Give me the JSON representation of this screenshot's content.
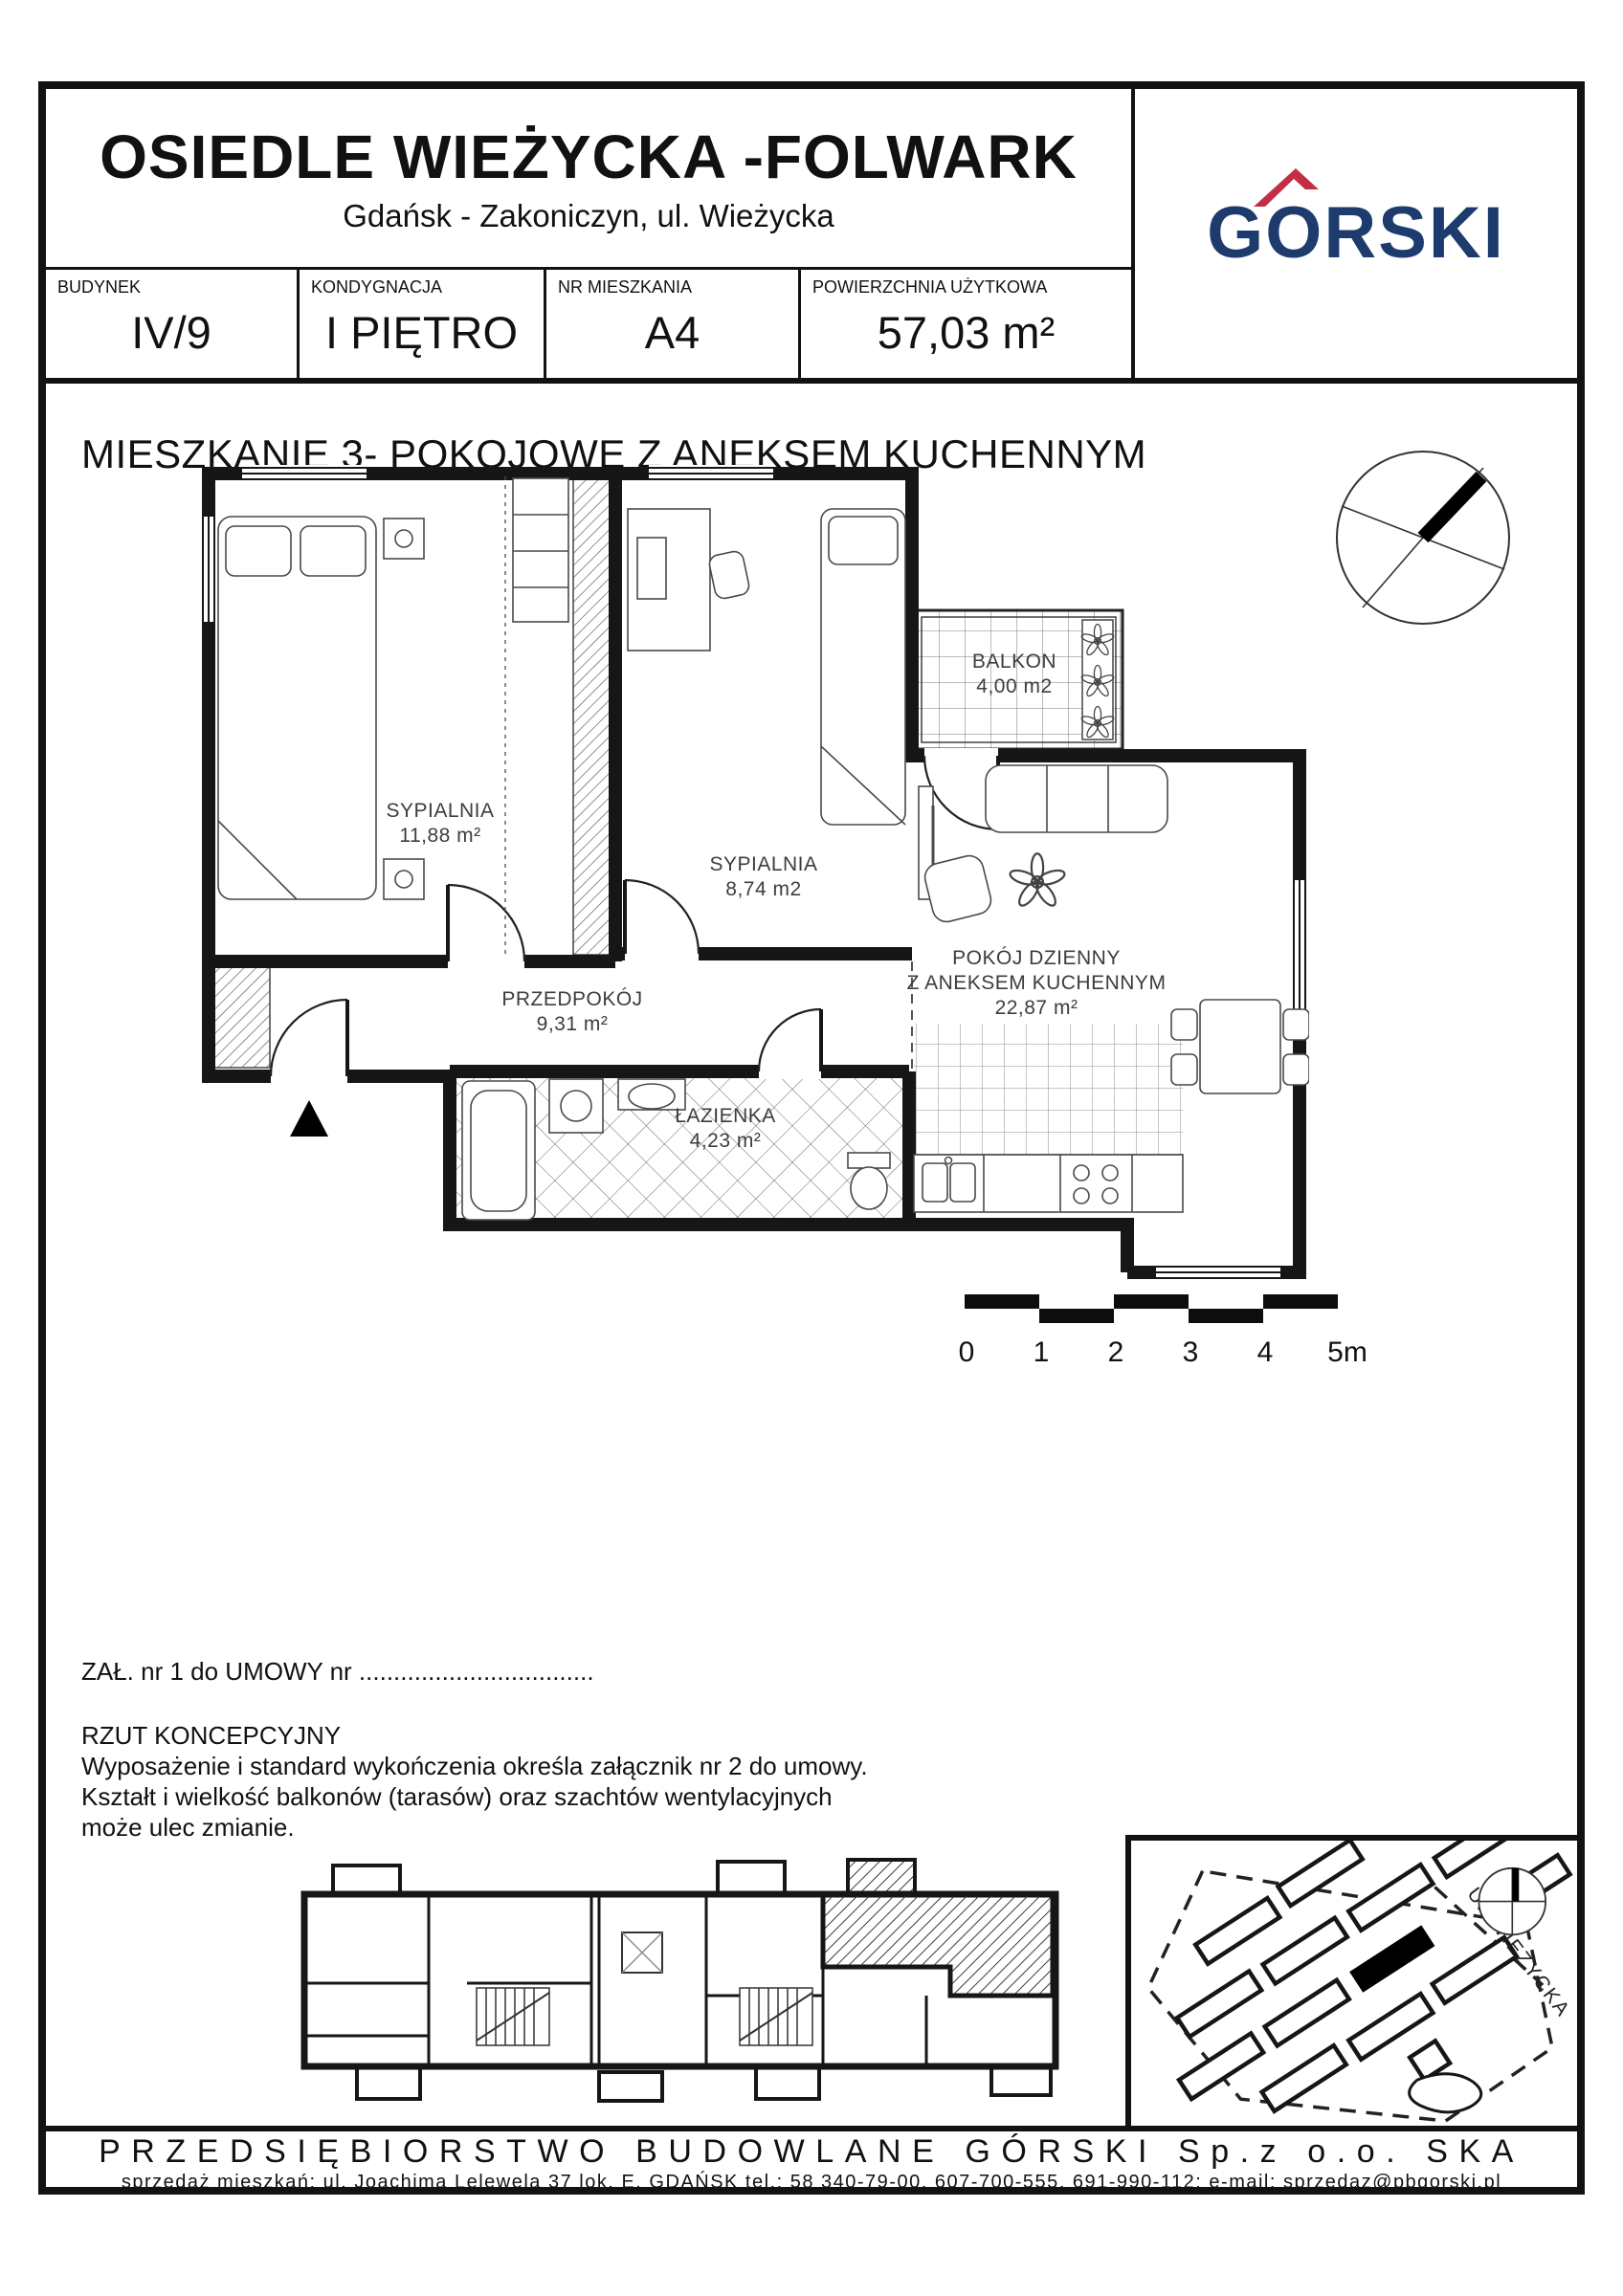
{
  "header": {
    "title": "OSIEDLE WIEŻYCKA -FOLWARK",
    "subtitle": "Gdańsk - Zakoniczyn, ul. Wieżycka",
    "logo": {
      "part_g": "G",
      "part_o": "O",
      "part_rest": "RSKI",
      "text_color": "#1d3c6d",
      "roof_color": "#c22f45"
    }
  },
  "info_table": {
    "cells": [
      {
        "label": "BUDYNEK",
        "value": "IV/9"
      },
      {
        "label": "KONDYGNACJA",
        "value": "I PIĘTRO"
      },
      {
        "label": "NR MIESZKANIA",
        "value": "A4"
      },
      {
        "label": "POWIERZCHNIA UŻYTKOWA",
        "value": "57,03 m²"
      }
    ]
  },
  "plan": {
    "heading": "MIESZKANIE 3- POKOJOWE  Z ANEKSEM KUCHENNYM",
    "rooms": [
      {
        "name": "SYPIALNIA",
        "area": "11,88 m²"
      },
      {
        "name": "SYPIALNIA",
        "area": "8,74 m2"
      },
      {
        "name": "BALKON",
        "area": "4,00 m2"
      },
      {
        "name": "PRZEDPOKÓJ",
        "area": "9,31 m²"
      },
      {
        "name": "ŁAZIENKA",
        "area": "4,23 m²"
      },
      {
        "name": "POKÓJ DZIENNY",
        "name2": "Z ANEKSEM KUCHENNYM",
        "area": "22,87 m²"
      }
    ],
    "scale_labels": [
      "0",
      "1",
      "2",
      "3",
      "4",
      "5m"
    ]
  },
  "notes": {
    "attachment": "ZAŁ. nr  1  do  UMOWY nr ..................................",
    "line1": "RZUT KONCEPCYJNY",
    "line2": "Wyposażenie i standard wykończenia określa załącznik nr 2 do umowy.",
    "line3": "Kształt i wielkość balkonów (tarasów) oraz szachtów wentylacyjnych",
    "line4": "może ulec zmianie."
  },
  "site_map": {
    "street_label": "UL.WIEŻYCKA"
  },
  "footer": {
    "company": "PRZEDSIĘBIORSTWO BUDOWLANE GÓRSKI Sp.z o.o. SKA",
    "contact": "sprzedaż mieszkań:  ul. Joachima Lelewela 37 lok. E, GDAŃSK  tel.: 58 340-79-00, 607-700-555, 691-990-112; e-mail: sprzedaz@pbgorski.pl"
  }
}
